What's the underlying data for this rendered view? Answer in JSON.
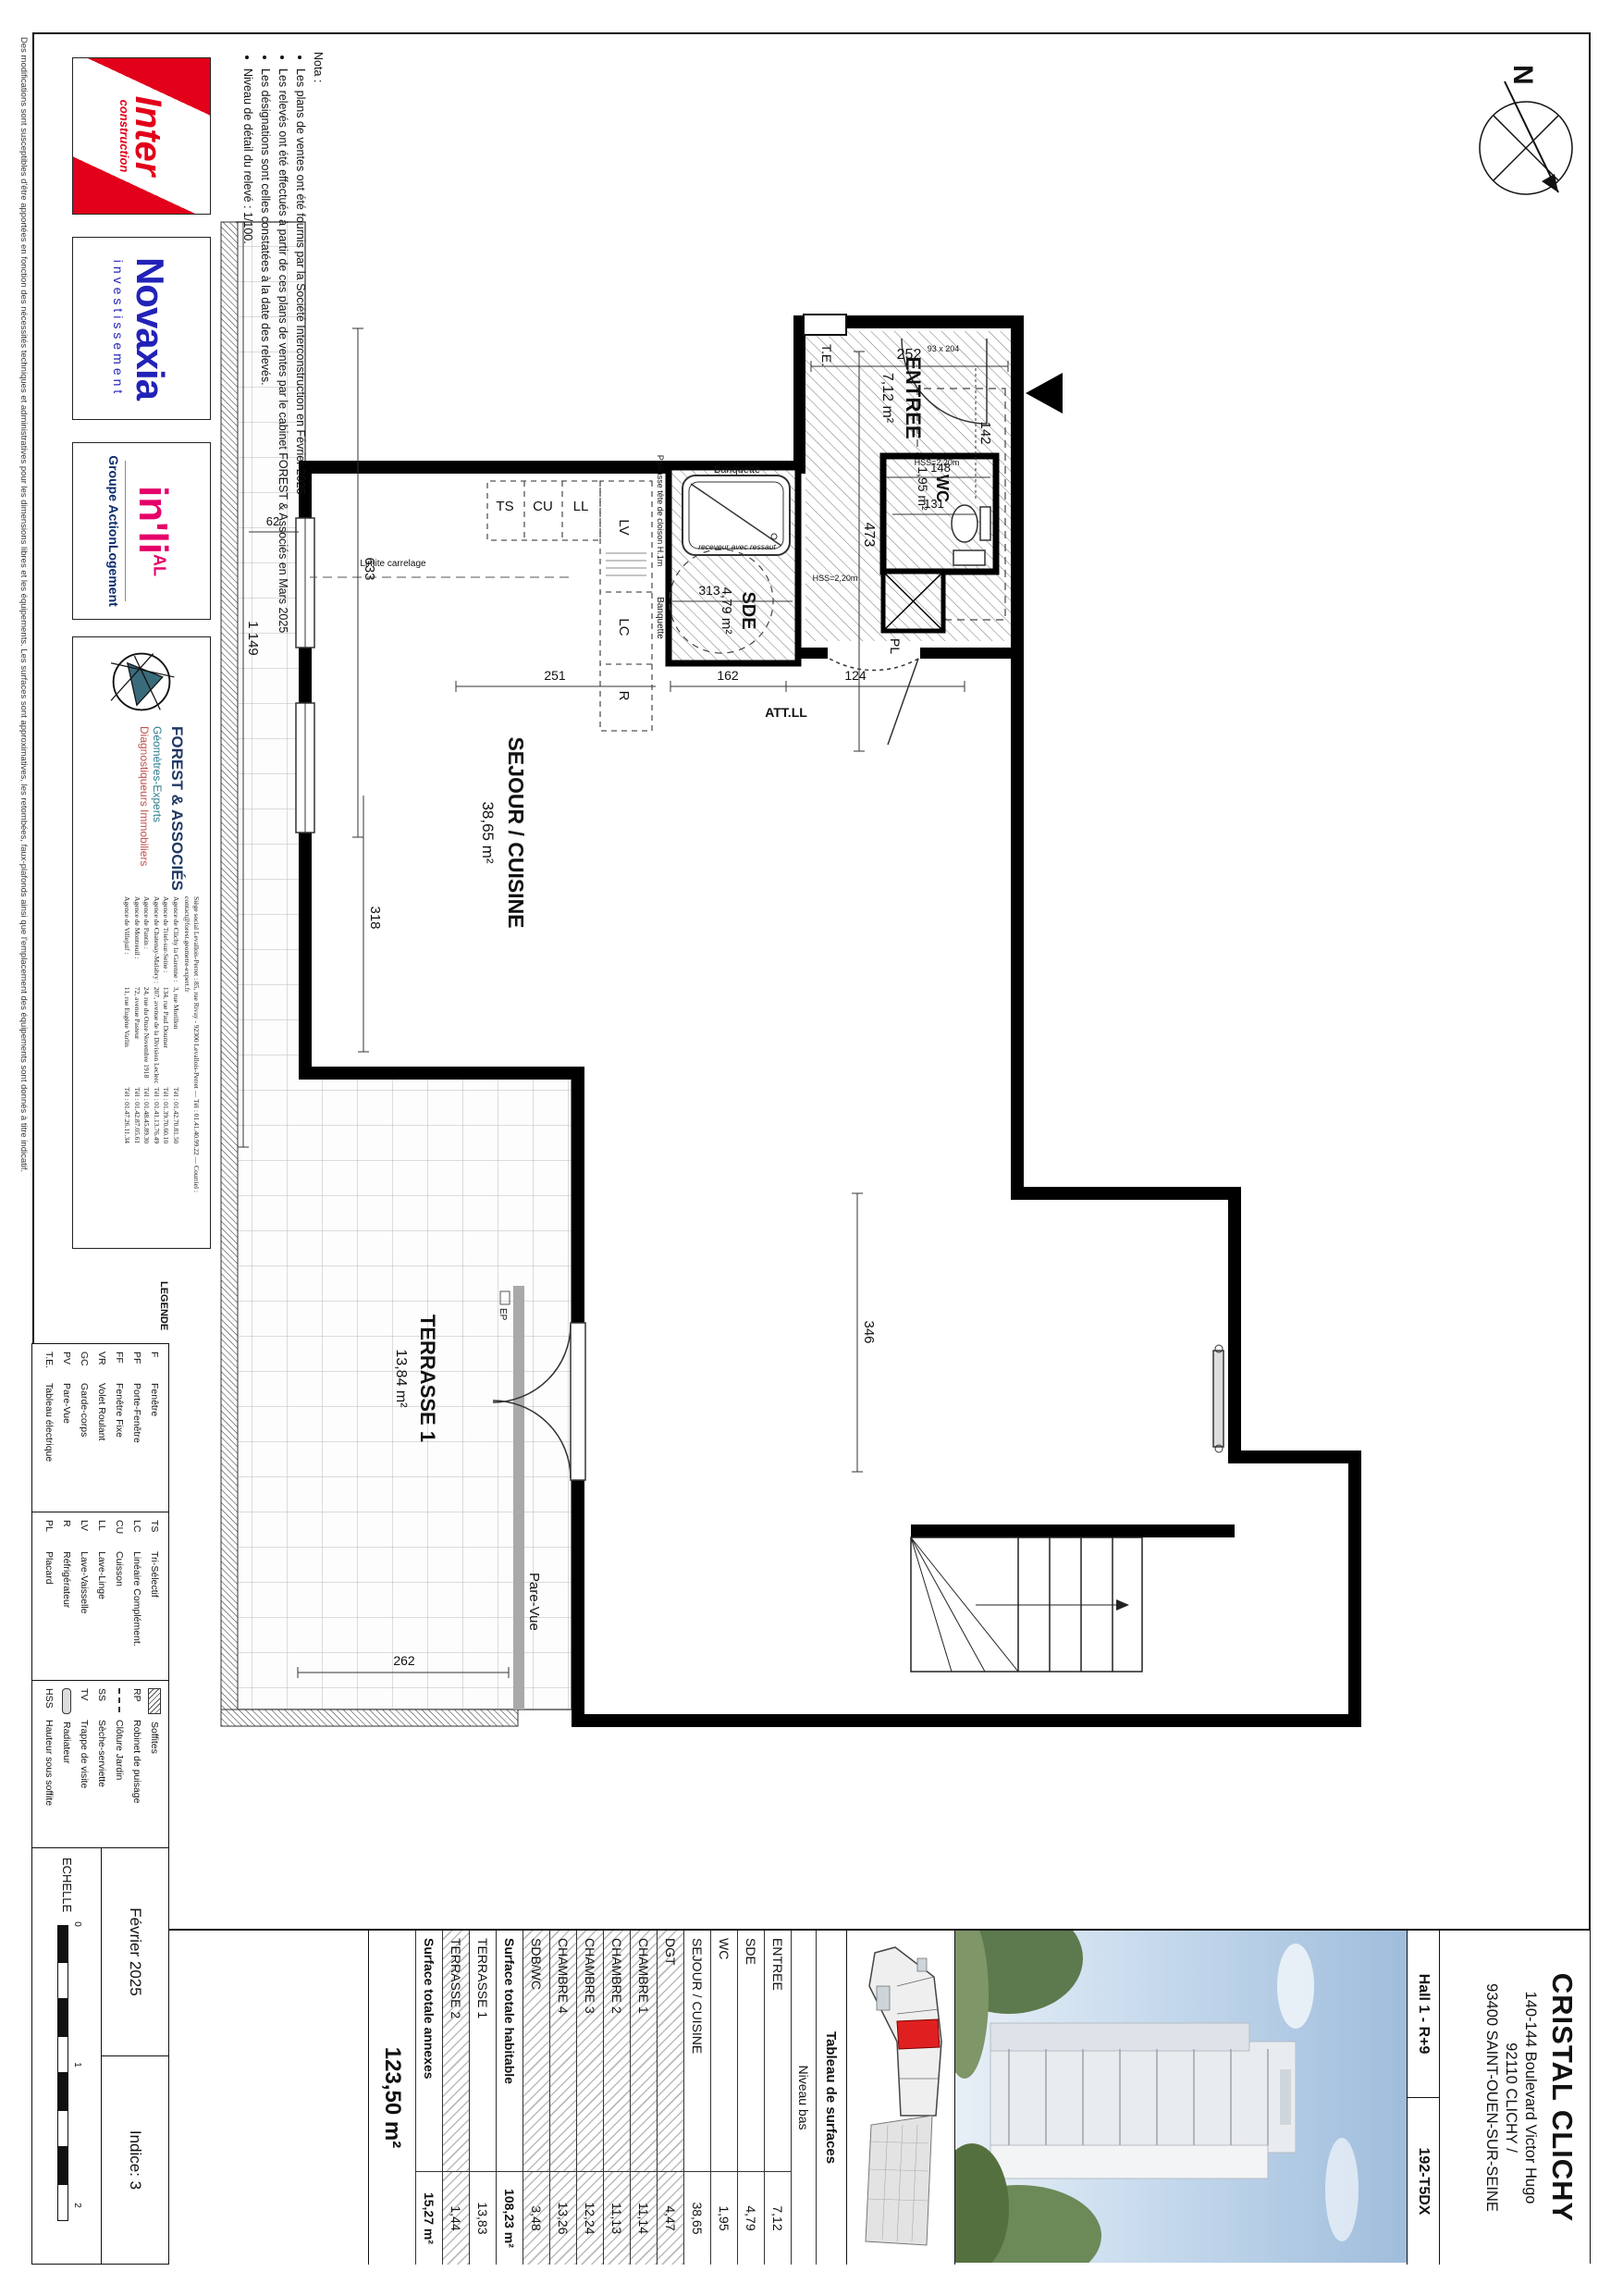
{
  "sheet": {
    "disclaimer": "Des modifications sont susceptibles d'être apportées en fonction des nécessités techniques et administratives pour les dimensions libres et les équipements. Les surfaces sont approximatives, les retombées, faux-plafonds ainsi que l'emplacement des équipements sont donnés à titre indicatif.",
    "nota_title": "Nota :",
    "nota": [
      "Les plans de ventes ont été fournis par la Société Interconstruction en Février 2025",
      "Les relevés ont été effectués à partir de ces plans de ventes par le cabinet FOREST & Associés en Mars 2025",
      "Les désignations sont celles constatées à la date des relevés.",
      "Niveau de détail du relevé : 1/100."
    ]
  },
  "logos": {
    "inter": {
      "line1": "Inter",
      "line2": "construction",
      "color": "#e2001a"
    },
    "novaxia": {
      "name": "Novaxia",
      "sub": "investissement",
      "color": "#2222b8"
    },
    "inli": {
      "name": "in'li",
      "badge": "AL",
      "sub": "Groupe ActionLogement",
      "color": "#e50069",
      "sub_color": "#0b2c6f"
    },
    "forest": {
      "name": "FOREST & ASSOCIÉS",
      "line2": "Géomètres-Experts",
      "line3": "Diagnostiqueurs Immobiliers",
      "siege": "Siège social Levallois-Perret : 85, rue Rivay - 92300 Levallois-Perret",
      "contact": "Tél : 01.41.40.99.22 — Courriel : contact@forest.geometre-expert.fr",
      "agencies": [
        {
          "name": "Agence de Clichy la Garenne :",
          "addr": "3, rue Morillon",
          "tel": "Tél : 01.42.70.81.50"
        },
        {
          "name": "Agence de Triel-sur-Seine :",
          "addr": "134, rue Paul Doumer",
          "tel": "Tél : 01.39.70.60.10"
        },
        {
          "name": "Agence de Chatenay-Malabry :",
          "addr": "207, avenue de la Division Leclerc",
          "tel": "Tél : 01.41.13.76.49"
        },
        {
          "name": "Agence de Pantin :",
          "addr": "24, rue du Onze Novembre 1918",
          "tel": "Tél : 01.48.45.89.30"
        },
        {
          "name": "Agence de Montreuil :",
          "addr": "72, avenue Pasteur",
          "tel": "Tél : 01.42.87.05.61"
        },
        {
          "name": "Agence de Villejuif :",
          "addr": "11, rue Eugène Varlin",
          "tel": "Tél : 01.47.26.11.34"
        }
      ]
    }
  },
  "legend": {
    "title": "LEGENDE",
    "col1": [
      {
        "code": "F",
        "label": "Fenêtre"
      },
      {
        "code": "PF",
        "label": "Porte-Fenêtre"
      },
      {
        "code": "FF",
        "label": "Fenêtre Fixe"
      },
      {
        "code": "VR",
        "label": "Volet Roulant"
      },
      {
        "code": "GC",
        "label": "Garde-corps"
      },
      {
        "code": "PV",
        "label": "Pare-Vue"
      },
      {
        "code": "T.E.",
        "label": "Tableau électrique"
      }
    ],
    "col2": [
      {
        "code": "TS",
        "label": "Tri-Sélectif"
      },
      {
        "code": "LC",
        "label": "Linéaire Complément."
      },
      {
        "code": "CU",
        "label": "Cuisson"
      },
      {
        "code": "LL",
        "label": "Lave-Linge"
      },
      {
        "code": "LV",
        "label": "Lave-Vaisselle"
      },
      {
        "code": "R",
        "label": "Réfrigérateur"
      },
      {
        "code": "PL",
        "label": "Placard"
      }
    ],
    "col3": [
      {
        "code": "",
        "label": "Soffites",
        "swatch": "hatch"
      },
      {
        "code": "RP",
        "label": "Robinet de puisage"
      },
      {
        "code": "",
        "label": "Clôture Jardin",
        "swatch": "dash"
      },
      {
        "code": "SS",
        "label": "Sèche-serviette"
      },
      {
        "code": "TV",
        "label": "Trappe de visite"
      },
      {
        "code": "",
        "label": "Radiateur",
        "swatch": "radiator"
      },
      {
        "code": "HSS",
        "label": "Hauteur sous soffite"
      }
    ]
  },
  "title_block": {
    "project": "CRISTAL CLICHY",
    "address1": "140-144 Boulevard Victor Hugo",
    "address2": "92110 CLICHY /",
    "address3": "93400 SAINT-OUEN-SUR-SEINE",
    "hall": "Hall 1 - R+9",
    "lot": "192-T5DX",
    "date": "Février 2025",
    "indice": "Indice: 3",
    "scale_label": "ECHELLE",
    "scale_ticks": {
      "t0": "0",
      "t1": "1",
      "t2": "2"
    }
  },
  "surface_table": {
    "header": "Tableau de surfaces",
    "subheader": "Niveau bas",
    "rows": [
      {
        "name": "ENTREE",
        "value": "7,12"
      },
      {
        "name": "SDE",
        "value": "4,79"
      },
      {
        "name": "WC",
        "value": "1,95"
      },
      {
        "name": "SEJOUR / CUISINE",
        "value": "38,65"
      },
      {
        "name": "DGT",
        "value": "4,47"
      },
      {
        "name": "CHAMBRE 1",
        "value": "11,14"
      },
      {
        "name": "CHAMBRE 2",
        "value": "11,13"
      },
      {
        "name": "CHAMBRE 3",
        "value": "12,24"
      },
      {
        "name": "CHAMBRE 4",
        "value": "13,26"
      },
      {
        "name": "SDB/WC",
        "value": "3,48"
      }
    ],
    "total_habitable": {
      "name": "Surface totale habitable",
      "value": "108,23 m²"
    },
    "annex_rows": [
      {
        "name": "TERRASSE 1",
        "value": "13,83"
      },
      {
        "name": "TERRASSE 2",
        "value": "1,44"
      }
    ],
    "total_annexes": {
      "name": "Surface totale annexes",
      "value": "15,27 m²"
    },
    "total": "123,50 m²"
  },
  "plan": {
    "north": "N",
    "rooms": [
      {
        "name": "ENTREE",
        "area": "7,12 m²"
      },
      {
        "name": "WC",
        "area": "1,95 m²"
      },
      {
        "name": "SDE",
        "area": "4,79 m²"
      },
      {
        "name": "SEJOUR / CUISINE",
        "area": "38,65 m²"
      },
      {
        "name": "TERRASSE 1",
        "area": "13,84 m²"
      }
    ],
    "labels": {
      "te": "T.E.",
      "pl": "PL",
      "ep": "EP",
      "banquette": "Banquette",
      "banquette2": "Banquette",
      "receveur": "receveur avec ressaut",
      "paillasse": "Paillasse tête de cloison H.1m",
      "pare_vue": "Pare-Vue",
      "limite": "Limite carrelage",
      "att_ll": "ATT.LL",
      "hss_a": "HSS=2,20m",
      "hss_b": "HSS=2,20m",
      "door_size": "93 x 204",
      "ts": "TS",
      "cu": "CU",
      "ll": "LL",
      "lv": "LV",
      "lc": "LC",
      "r": "R"
    },
    "dims": {
      "d252": "252",
      "d142": "142",
      "d148": "148",
      "d131": "131",
      "d473": "473",
      "d313": "313",
      "d162": "162",
      "d124": "124",
      "d251": "251",
      "d633": "633",
      "d1149": "1 149",
      "d62": "62",
      "d318": "318",
      "d262": "262",
      "d346": "346"
    }
  }
}
